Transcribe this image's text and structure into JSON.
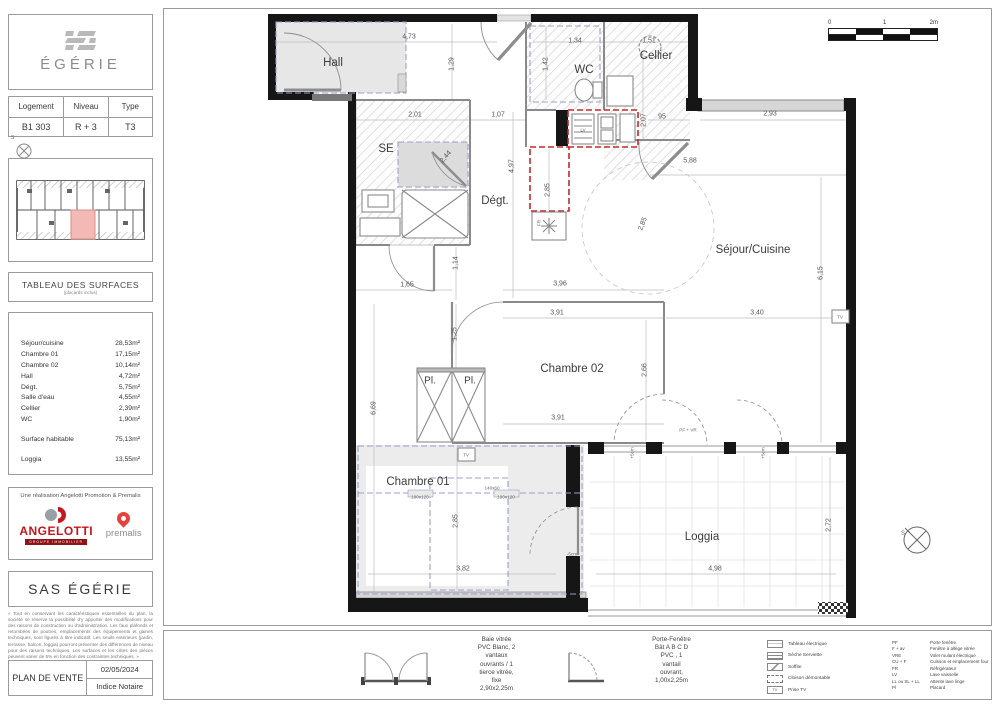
{
  "sidebar": {
    "brand": "ÉGÉRIE",
    "unit_table": {
      "headers": [
        "Logement",
        "Niveau",
        "Type"
      ],
      "values": [
        "B1 303",
        "R + 3",
        "T3"
      ]
    },
    "compass": "S",
    "surfaces": {
      "title": "TABLEAU DES SURFACES",
      "subtitle": "(placards inclus)",
      "rows": [
        {
          "label": "Séjour/cuisine",
          "value": "28,53m²"
        },
        {
          "label": "Chambre 01",
          "value": "17,15m²"
        },
        {
          "label": "Chambre 02",
          "value": "10,14m²"
        },
        {
          "label": "Hall",
          "value": "4,72m²"
        },
        {
          "label": "Dégt.",
          "value": "5,75m²"
        },
        {
          "label": "Salle d'eau",
          "value": "4,55m²"
        },
        {
          "label": "Cellier",
          "value": "2,39m²"
        },
        {
          "label": "WC",
          "value": "1,90m²"
        }
      ],
      "totals": [
        {
          "label": "Surface habitable",
          "value": "75,13m²"
        },
        {
          "label": "Loggia",
          "value": "13,55m²"
        }
      ]
    },
    "realisation": "Une réalisation Angelotti Promotion & Premalis",
    "angelotti": {
      "name": "ANGELOTTI",
      "tagline": "GROUPE IMMOBILIER"
    },
    "premalis": "premalis",
    "company": "SAS ÉGÉRIE",
    "disclaimer": "« Tout en conservant les caractéristiques essentielles du plan, la société se réserve la possibilité d'y apporter des modifications pour des raisons de construction ou d'administration. Les faux plafonds et retombées de poutres, emplacements des équipements et gaines techniques, sont figurés à titre indicatif. Les seuils extérieurs (jardin, terrasse, balcon, loggia) pourront présenter des différences de niveau pour des raisons techniques. Les surfaces et les côtes des pièces peuvent varier de 5% en fonction des contraintes techniques. »",
    "plan_de_vente": {
      "label": "PLAN DE VENTE",
      "date": "02/05/2024",
      "indice": "Indice Notaire"
    }
  },
  "plan": {
    "scale": [
      "0",
      "1",
      "2m"
    ],
    "compass": "S",
    "labels": [
      {
        "t": "Hall",
        "x": 333,
        "y": 63,
        "k": "room"
      },
      {
        "t": "WC",
        "x": 584,
        "y": 70,
        "k": "room"
      },
      {
        "t": "Cellier",
        "x": 656,
        "y": 56,
        "k": "room"
      },
      {
        "t": "SE",
        "x": 386,
        "y": 149,
        "k": "room"
      },
      {
        "t": "Dégt.",
        "x": 495,
        "y": 201,
        "k": "room"
      },
      {
        "t": "Séjour/Cuisine",
        "x": 753,
        "y": 250,
        "k": "room"
      },
      {
        "t": "Chambre 02",
        "x": 572,
        "y": 369,
        "k": "room"
      },
      {
        "t": "Chambre 01",
        "x": 418,
        "y": 482,
        "k": "room"
      },
      {
        "t": "Loggia",
        "x": 702,
        "y": 537,
        "k": "room"
      },
      {
        "t": "Pl.",
        "x": 430,
        "y": 381,
        "k": "room2"
      },
      {
        "t": "Pl.",
        "x": 470,
        "y": 381,
        "k": "room2"
      },
      {
        "t": "4,73",
        "x": 409,
        "y": 37
      },
      {
        "t": "1,34",
        "x": 575,
        "y": 41
      },
      {
        "t": "1,51",
        "x": 649,
        "y": 41
      },
      {
        "t": "1,29",
        "x": 452,
        "y": 64,
        "r": -90
      },
      {
        "t": "1,42",
        "x": 546,
        "y": 64,
        "r": -90
      },
      {
        "t": "2,07",
        "x": 644,
        "y": 120,
        "r": -90
      },
      {
        "t": "95",
        "x": 662,
        "y": 117
      },
      {
        "t": "2,93",
        "x": 770,
        "y": 114
      },
      {
        "t": "2,01",
        "x": 415,
        "y": 115
      },
      {
        "t": "1,07",
        "x": 498,
        "y": 115
      },
      {
        "t": "2,44",
        "x": 446,
        "y": 157,
        "r": -50
      },
      {
        "t": "4,97",
        "x": 512,
        "y": 166,
        "r": -90
      },
      {
        "t": "5,88",
        "x": 690,
        "y": 161
      },
      {
        "t": "2,85",
        "x": 548,
        "y": 190,
        "r": -90
      },
      {
        "t": "2,85",
        "x": 643,
        "y": 224,
        "r": -68
      },
      {
        "t": "6,15",
        "x": 821,
        "y": 273,
        "r": -90
      },
      {
        "t": "3,40",
        "x": 757,
        "y": 313
      },
      {
        "t": "1,65",
        "x": 407,
        "y": 285
      },
      {
        "t": "1,14",
        "x": 456,
        "y": 263,
        "r": -90
      },
      {
        "t": "3,96",
        "x": 560,
        "y": 284
      },
      {
        "t": "3,91",
        "x": 557,
        "y": 313
      },
      {
        "t": "1,25",
        "x": 455,
        "y": 334,
        "r": -90
      },
      {
        "t": "2,66",
        "x": 645,
        "y": 370,
        "r": -90
      },
      {
        "t": "3,91",
        "x": 558,
        "y": 418
      },
      {
        "t": "6,69",
        "x": 374,
        "y": 408,
        "r": -90
      },
      {
        "t": "2,85",
        "x": 456,
        "y": 521,
        "r": -90
      },
      {
        "t": "3,82",
        "x": 463,
        "y": 569
      },
      {
        "t": "4,98",
        "x": 715,
        "y": 569
      },
      {
        "t": "2,72",
        "x": 829,
        "y": 525,
        "r": -90
      },
      {
        "t": "LV",
        "x": 583,
        "y": 130,
        "k": "tiny"
      },
      {
        "t": "FR",
        "x": 539,
        "y": 223,
        "r": -90,
        "k": "tiny"
      },
      {
        "t": "TV",
        "x": 840,
        "y": 317,
        "k": "tiny"
      },
      {
        "t": "TV",
        "x": 466,
        "y": 455,
        "k": "tiny"
      },
      {
        "t": "190x120",
        "x": 420,
        "y": 497,
        "k": "tiny"
      },
      {
        "t": "190x120",
        "x": 506,
        "y": 497,
        "k": "tiny"
      },
      {
        "t": "140x60",
        "x": 492,
        "y": 488,
        "k": "tiny"
      },
      {
        "t": "PF + VR",
        "x": 688,
        "y": 430,
        "k": "tiny"
      },
      {
        "t": "+5cm",
        "x": 632,
        "y": 453,
        "r": -90,
        "k": "tiny"
      },
      {
        "t": "+5cm",
        "x": 763,
        "y": 453,
        "r": -90,
        "k": "tiny"
      },
      {
        "t": "-5cm",
        "x": 572,
        "y": 554,
        "k": "tiny"
      }
    ]
  },
  "legend": {
    "baie": "Baie vitrée\nPVC Blanc, 2\nvantaux\nouvrants / 1\ntierce vitrée,\nfixe\n2,90x2,25m",
    "porte_fenetre": "Porte-Fenêtre\nBât A B C D\nPVC ,    1\nvantail\nouvrant,\n1,00x2,25m",
    "symbols": [
      {
        "icon": "tableau-electrique-icon",
        "label": "Tableau électrique"
      },
      {
        "icon": "seche-serviette-icon",
        "label": "Sèche Serviette"
      },
      {
        "icon": "soffite-icon",
        "label": "Soffite"
      },
      {
        "icon": "cloison-demontable-icon",
        "label": "Cloison démontable"
      },
      {
        "icon": "prise-tv-icon",
        "label": "Prise TV",
        "icon_text": "TV"
      }
    ],
    "abbreviations": [
      {
        "abbr": "PF",
        "label": "Porte fenêtre"
      },
      {
        "abbr": "F + av",
        "label": "Fenêtre à allège vitrée"
      },
      {
        "abbr": "VRE",
        "label": "Volet roulant électrique"
      },
      {
        "abbr": "CU + F",
        "label": "Cuisson et emplacement four"
      },
      {
        "abbr": "FR",
        "label": "Réfrigérateur"
      },
      {
        "abbr": "LV",
        "label": "Lave vaisselle"
      },
      {
        "abbr": "LL ou SL + LL",
        "label": "Attente lave linge"
      },
      {
        "abbr": "Pl",
        "label": "Placard"
      }
    ]
  }
}
